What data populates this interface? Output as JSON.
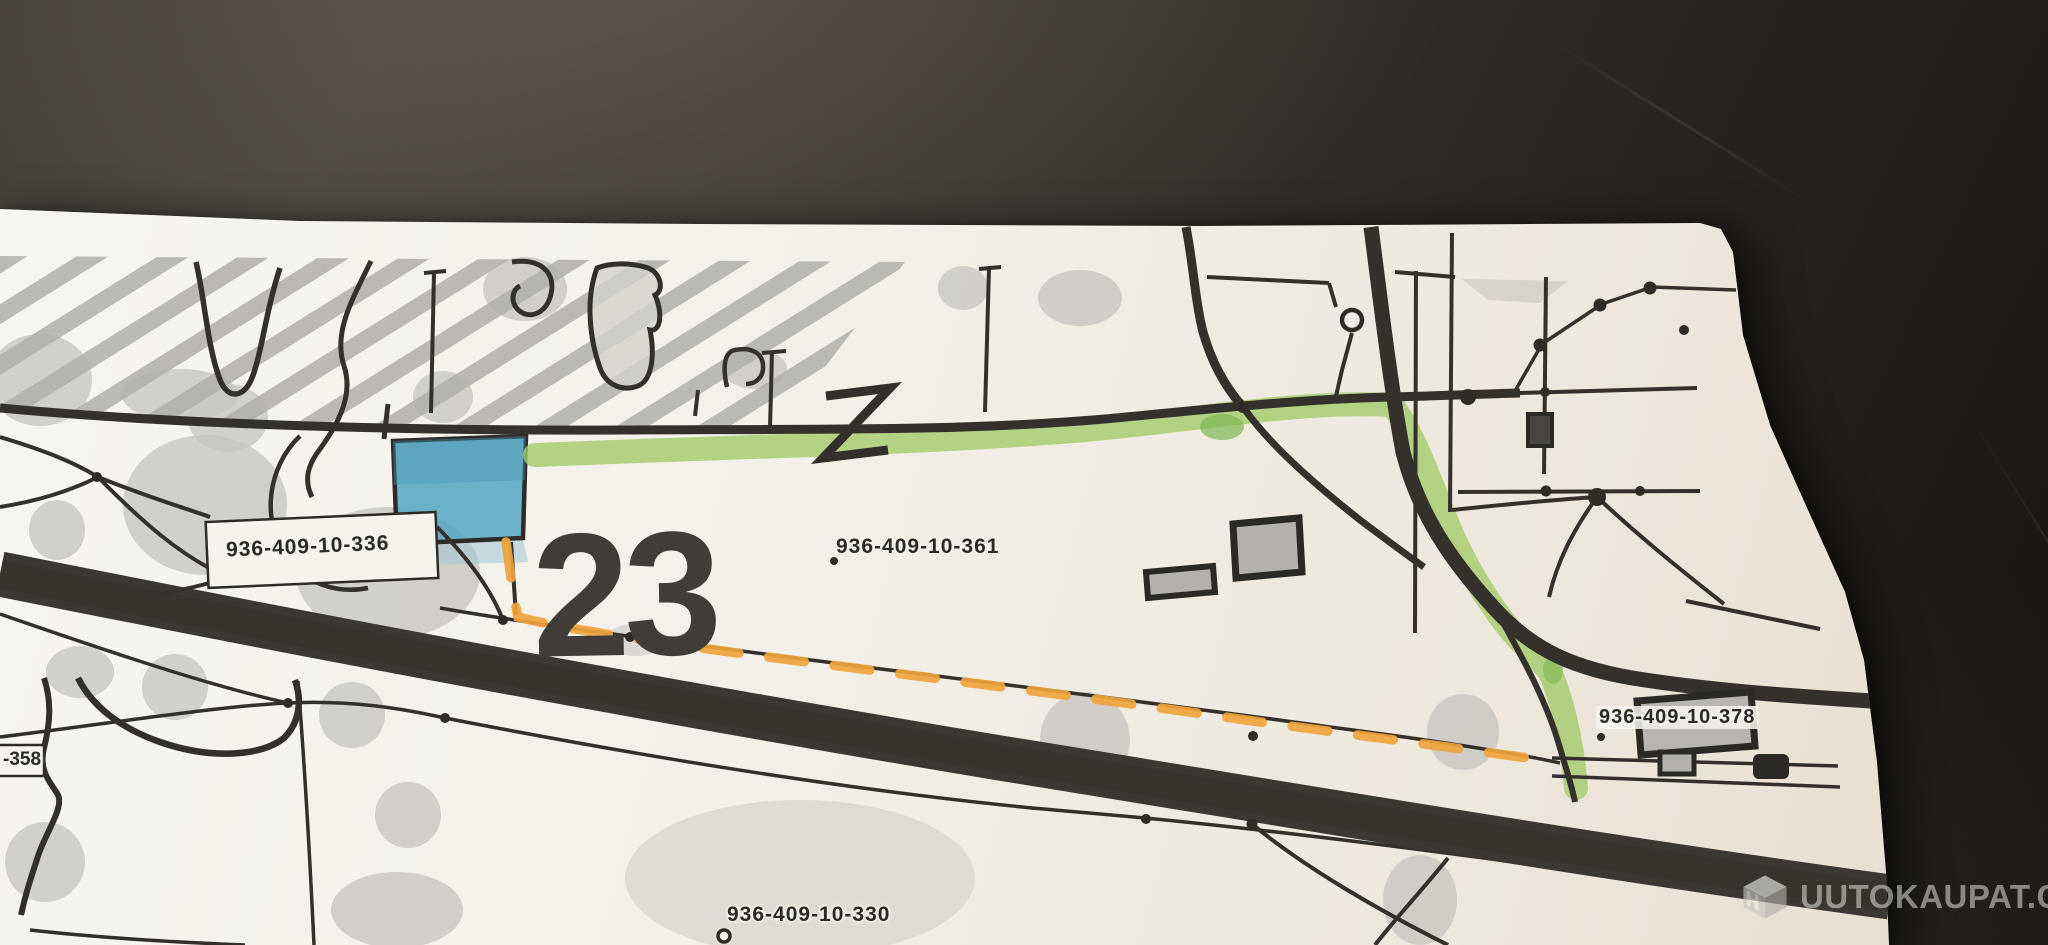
{
  "map": {
    "plot_number": "23",
    "labels": {
      "parcel_336": "936-409-10-336",
      "parcel_361": "936-409-10-361",
      "parcel_378": "936-409-10-378",
      "parcel_330": "936-409-10-330",
      "parcel_358_partial": "-358"
    },
    "colors": {
      "paper": "#f3f0e9",
      "ink": "#33302c",
      "highlight_green": "#a4cb6a",
      "highlight_orange": "#f0a43c",
      "highlight_blue": "#58a7c1",
      "hatch_gray": "#b2afaa",
      "vegetation_gray": "#c8c5c1"
    }
  },
  "watermark": {
    "logo_letter": "H",
    "text": "UUTOKAUPAT.COM"
  }
}
